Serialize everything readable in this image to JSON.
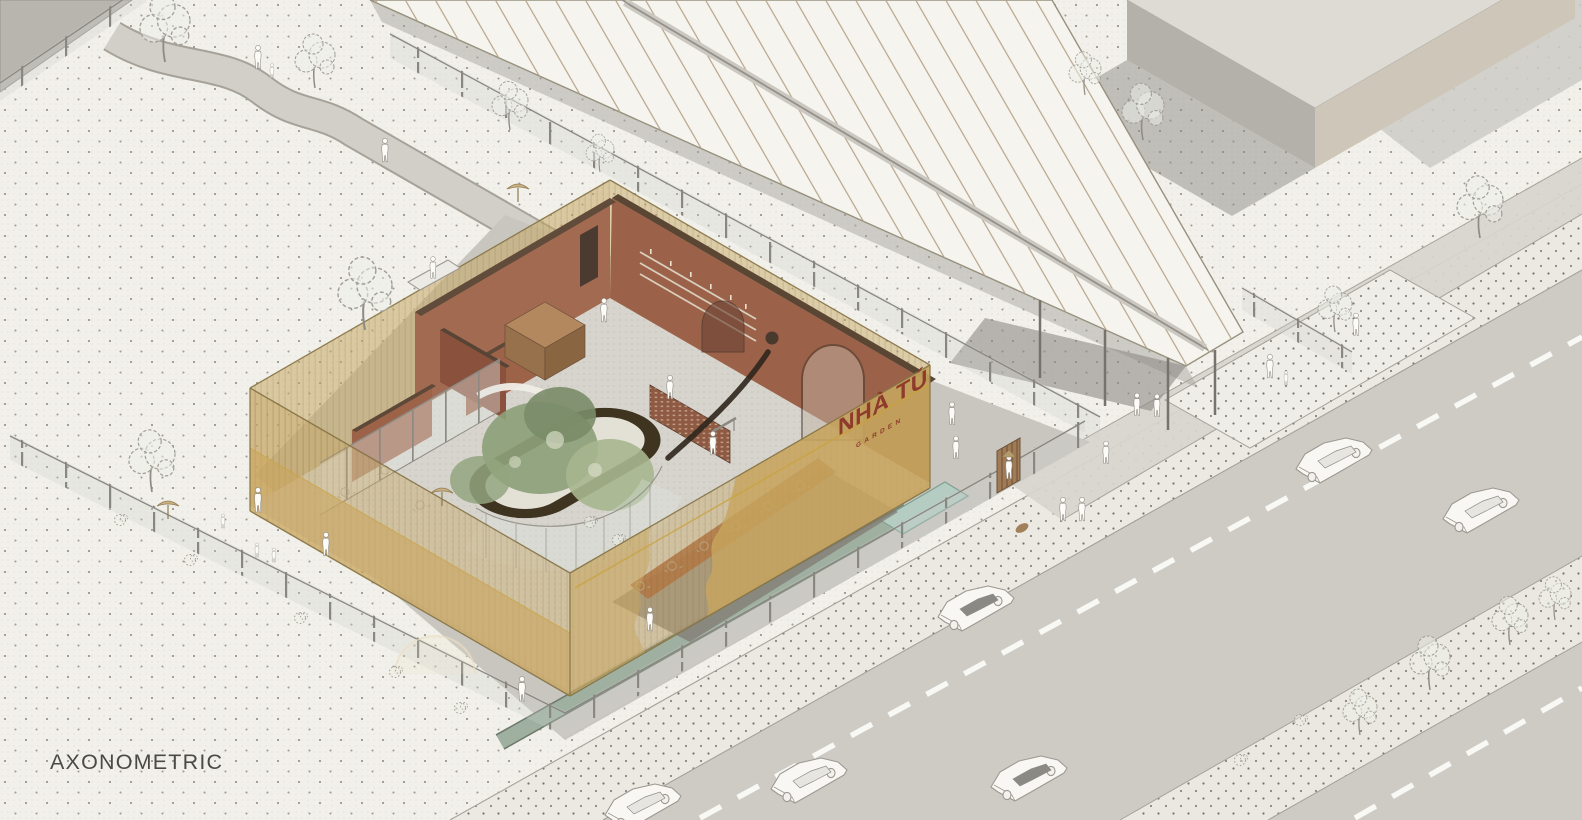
{
  "labels": {
    "drawing_title": "AXONOMETRIC"
  },
  "building": {
    "sign": "NHÀ TÚ",
    "sign_sub": "GARDEN"
  },
  "palette": {
    "paper": "#f2f0ea",
    "dot": "#56524b",
    "road": "#cecbc5",
    "sidewalk": "#ebe9e2",
    "plaza": "#c9c6c0",
    "canopy": "#f6f4ee",
    "canopy_rib": "#b5a48c",
    "mesh_khaki": "#c5a763",
    "mesh_band": "#c7a55e",
    "terracotta": "#9c6149",
    "wall_top": "#5a4633",
    "floor": "#d7d4ce",
    "ring": "#3f341f",
    "foliage": "#8da07a",
    "water_channel": "#9fb0a0",
    "pool": "#b5ccc2",
    "accent_gold": "#c9a33e",
    "sign_red": "#8e3b2c",
    "title_gray": "#4b4a46",
    "sketch_gray": "#a3a098",
    "block_gray": "#b4b1ab"
  },
  "scene": {
    "type": "architectural axonometric illustration",
    "landmarks": [
      "cafe building with translucent khaki mesh facade",
      "oval courtyard ring with green trees",
      "white striped parking canopy",
      "neighbor building block top-right",
      "roads with white dashed lane markings",
      "glass perimeter fences with posts",
      "entrance gate with slatted door",
      "water channel and pool",
      "pedestrian silhouettes",
      "line-art cars",
      "sketch trees on dotted paper ground"
    ]
  }
}
